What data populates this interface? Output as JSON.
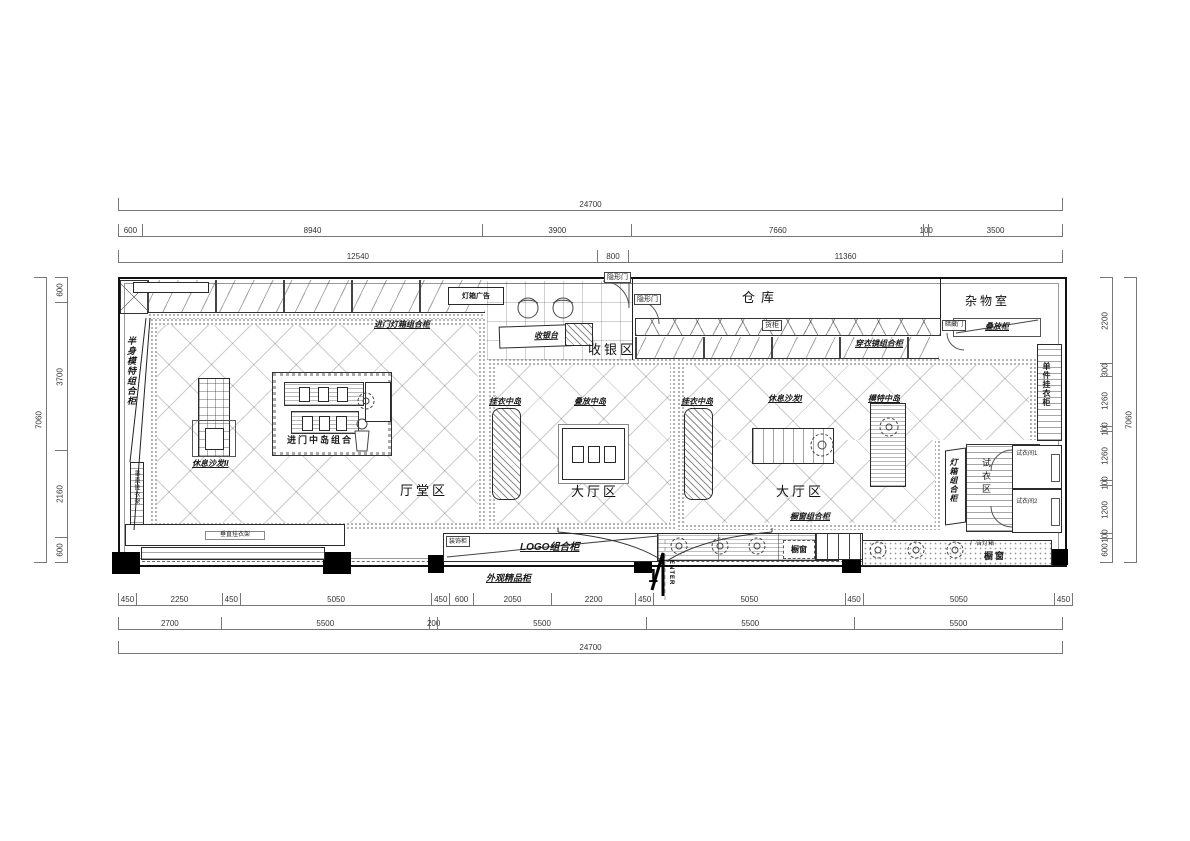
{
  "plan": {
    "areas": {
      "hall": "厅堂区",
      "cashier": "收银区",
      "warehouse": "仓库",
      "storage": "杂物室",
      "main_center": "大厅区",
      "main_right": "大厅区",
      "fitting": "试衣区"
    },
    "islands": {
      "entry": "进门中岛组合",
      "hang1": "挂衣中岛",
      "stack": "叠放中岛",
      "hang2": "挂衣中岛",
      "mannequin": "模特中岛"
    },
    "sofas": {
      "sofa1": "休息沙发I",
      "sofa2": "休息沙发II"
    },
    "cabinets": {
      "entry_lightbox": "进门灯箱组合柜",
      "half_mannequin": "半身模特组合柜",
      "mirror_combo": "穿衣镜组合柜",
      "stack": "叠放柜",
      "single_hang": "单件挂衣柜",
      "lightbox_combo": "灯箱组合柜",
      "window_combo": "橱窗组合柜",
      "logo_combo": "LOGO组合柜",
      "exterior_boutique": "外观精品柜",
      "decor": "装饰柜",
      "cargo": "货柜",
      "wall_rack": "垂直挂衣架"
    },
    "fitting_rooms": {
      "room1": "试衣间1",
      "room2": "试衣间2"
    },
    "doors": {
      "hidden1": "隐形门",
      "hidden2": "隐形门",
      "concealed": "暗藏门"
    },
    "signs": {
      "lightbox_ad": "灯箱广告",
      "ad_lightbox": "广告灯箱",
      "window1": "橱窗",
      "window2": "橱窗"
    },
    "cashier_desk": "收银台",
    "entrance": {
      "num": "1",
      "text": "ENTER"
    }
  },
  "dimensions": {
    "top_total": [
      24700
    ],
    "top_row2": [
      600,
      8940,
      3900,
      7660,
      100,
      3500
    ],
    "top_row3": [
      12540,
      800,
      11360
    ],
    "bottom_row1": [
      450,
      2250,
      450,
      5050,
      450,
      600,
      2050,
      2200,
      450,
      5050,
      450,
      5050,
      450
    ],
    "bottom_row2": [
      2700,
      5500,
      200,
      5500,
      5500,
      5500
    ],
    "bottom_total": [
      24700
    ],
    "left": [
      600,
      3700,
      2160,
      600
    ],
    "left_total": [
      7060
    ],
    "right": [
      2200,
      300,
      1260,
      100,
      1260,
      100,
      1200,
      100,
      600
    ],
    "right_total": [
      7060
    ]
  }
}
